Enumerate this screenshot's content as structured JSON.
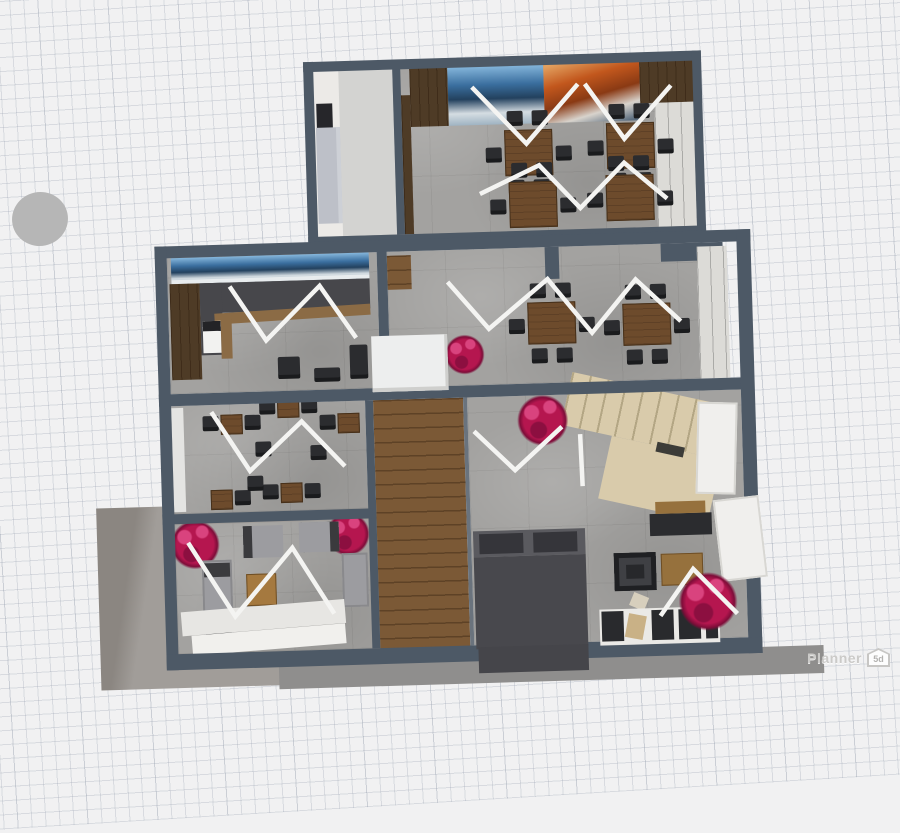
{
  "app": {
    "watermark_brand": "Planner",
    "watermark_badge": "5d"
  },
  "floorplan": {
    "view": "3d top-down render of a two-wing floor plan",
    "rooms": [
      {
        "name": "dining-hall",
        "features": [
          "mountain wall mural (blue peaks + orange rock)",
          "4 wooden dining tables",
          "black chairs",
          "white zigzag floor markers",
          "window wall right"
        ]
      },
      {
        "name": "stair-lobby",
        "features": [
          "white walls",
          "gray concrete floor",
          "light gray counter",
          "dark doorway"
        ]
      },
      {
        "name": "bar-cafe",
        "features": [
          "blue panorama mural",
          "L-shaped dark bar counter with wood trim",
          "coffee machine",
          "bar chairs",
          "zigzag marker"
        ]
      },
      {
        "name": "dining-room-2",
        "features": [
          "2 wooden dining tables with 6 chairs",
          "magenta plant",
          "white service box",
          "window wall right",
          "zigzag marker"
        ]
      },
      {
        "name": "cafe-seating",
        "features": [
          "5 small wooden tables",
          "black armchairs",
          "zigzag marker"
        ]
      },
      {
        "name": "lounge",
        "features": [
          "2 magenta plants",
          "gray sofas and armchairs",
          "wooden coffee table",
          "white steps",
          "zigzag marker"
        ]
      },
      {
        "name": "living-area",
        "features": [
          "beige L staircase",
          "wood plank corridor",
          "dark bed with pillows",
          "white sofa with black cushions",
          "2 magenta plants",
          "wooden side tables",
          "white open doors",
          "zigzag markers"
        ]
      }
    ]
  },
  "colors": {
    "wall": "#4d5966",
    "floor": "#a3a2a0",
    "wood": "#7b5936",
    "woodDark": "#4e3b26",
    "table": "#6d4b2c",
    "chair": "#2b2c2f",
    "plant": "#b5164f",
    "plantLight": "#d9437e",
    "zigzag": "#f4f4f2",
    "stairs": "#d9cbab",
    "stairsLine": "#b3a684",
    "counter": "#47474b",
    "counterTrim": "#8b6b45",
    "windowBand": "#dcdbd7",
    "doorWhite": "#f0efed",
    "terrace": "#a19d99",
    "terraceDark": "#8b8681",
    "gridBg": "#f1f1f2",
    "gridLine": "rgba(150,160,175,0.28)",
    "ellipse": "#b6b6b6",
    "bedBody": "#48484d",
    "bedPillow": "#35353a",
    "sofaGray": "#9c9ca0"
  }
}
